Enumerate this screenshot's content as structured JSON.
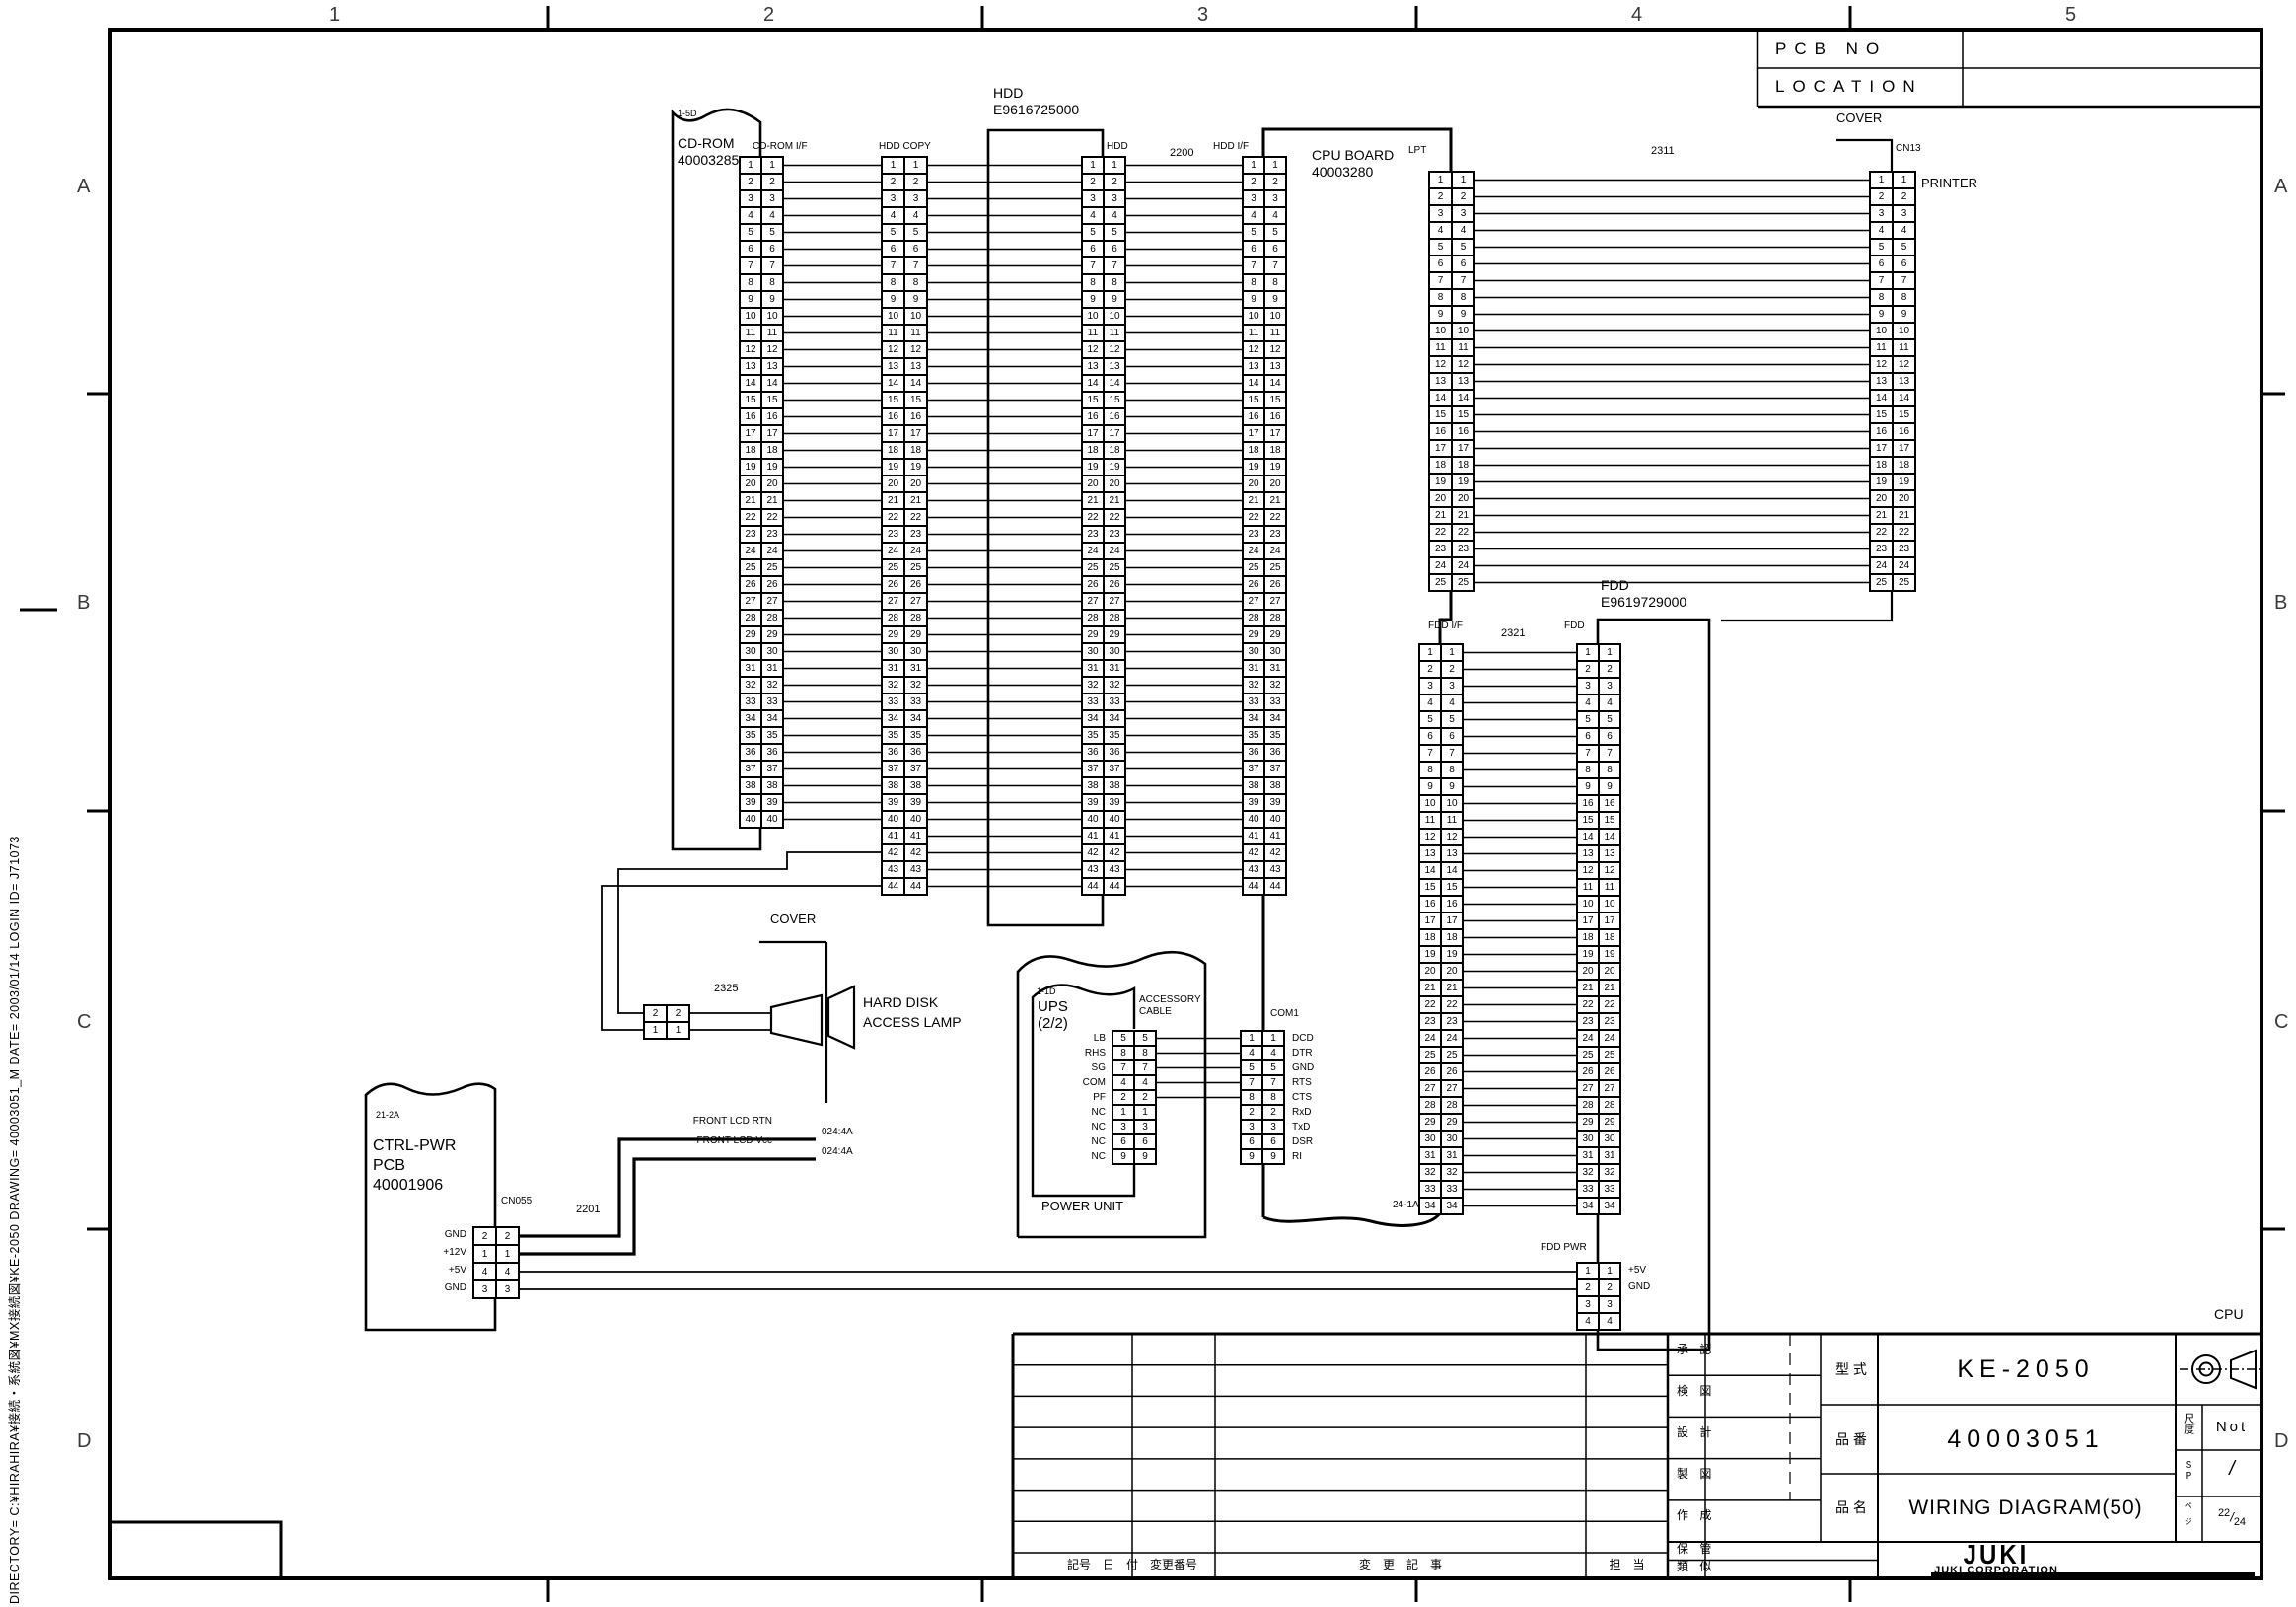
{
  "frame": {
    "zone_cols": [
      "1",
      "2",
      "3",
      "4",
      "5"
    ],
    "zone_rows": [
      "A",
      "B",
      "C",
      "D"
    ],
    "footer_note": "DIRECTORY= C:¥HIRAHIRA¥接続・系統図¥MX接続図¥KE-2050 DRAWING= 40003051_M DATE= 2003/01/14 LOGIN ID= J71073"
  },
  "pcb_table": {
    "row1_label": "PCB NO",
    "row2_label": "LOCATION"
  },
  "labels": {
    "cover_top": "COVER",
    "cn13": "CN13",
    "printer": "PRINTER",
    "cable_2311": "2311",
    "lpt": "LPT",
    "cpu_board_l1": "CPU BOARD",
    "cpu_board_l2": "40003280",
    "cdrom_zone": "1-5D",
    "cdrom_l1": "CD-ROM",
    "cdrom_l2": "40003285",
    "cdrom_if": "CD-ROM I/F",
    "hdd_copy": "HDD COPY",
    "hdd_unit_l1": "HDD",
    "hdd_unit_l2": "E9616725000",
    "hdd": "HDD",
    "cable_2200": "2200",
    "hdd_if": "HDD I/F",
    "fdd_unit_l1": "FDD",
    "fdd_unit_l2": "E9619729000",
    "fdd_if": "FDD I/F",
    "cable_2321": "2321",
    "fdd": "FDD",
    "zone_24_1a": "24-1A",
    "fdd_pwr": "FDD PWR",
    "com1": "COM1",
    "ups_zone": "1-1D",
    "ups_l1": "UPS",
    "ups_l2": "(2/2)",
    "accessory_l1": "ACCESSORY",
    "accessory_l2": "CABLE",
    "power_unit": "POWER UNIT",
    "ctrl_zone": "21-2A",
    "ctrl_l1": "CTRL-PWR",
    "ctrl_l2": "PCB",
    "ctrl_l3": "40001906",
    "cn055": "CN055",
    "cable_2201": "2201",
    "front_lcd_rtn": "FRONT LCD RTN",
    "front_lcd_vcc": "FRONT LCD Vcc",
    "dest_rtn": "024:4A",
    "dest_vcc": "024:4A",
    "cover_mid": "COVER",
    "cable_2325": "2325",
    "lamp_l1": "HARD DISK",
    "lamp_l2": "ACCESS LAMP",
    "cpu_note": "CPU"
  },
  "connectors": {
    "cdrom_if": {
      "pin_start": 1,
      "pin_count": 40
    },
    "hdd_copy": {
      "pin_start": 1,
      "pin_count": 44
    },
    "hdd": {
      "pin_start": 1,
      "pin_count": 44
    },
    "hdd_if": {
      "pin_start": 1,
      "pin_count": 44
    },
    "lpt": {
      "pin_start": 1,
      "pin_count": 25
    },
    "cn13": {
      "pin_start": 1,
      "pin_count": 25
    },
    "fdd_if": {
      "pin_start": 1,
      "pin_count": 34
    },
    "fdd": {
      "pins": [
        1,
        2,
        3,
        4,
        5,
        6,
        7,
        8,
        9,
        16,
        15,
        14,
        13,
        12,
        11,
        10,
        17,
        18,
        19,
        20,
        21,
        22,
        23,
        24,
        25,
        26,
        27,
        28,
        29,
        30,
        31,
        32,
        33,
        34
      ]
    },
    "fdd_pwr": {
      "pins": [
        1,
        2,
        3,
        4
      ],
      "right_labels": [
        "+5V",
        "GND",
        "",
        ""
      ]
    },
    "com1": {
      "pins": [
        1,
        4,
        5,
        7,
        8,
        2,
        3,
        6,
        9
      ],
      "right_labels": [
        "DCD",
        "DTR",
        "GND",
        "RTS",
        "CTS",
        "RxD",
        "TxD",
        "DSR",
        "RI"
      ]
    },
    "ups_acc": {
      "pins": [
        5,
        8,
        7,
        4,
        2,
        1,
        3,
        6,
        9
      ],
      "left_labels": [
        "LB",
        "RHS",
        "SG",
        "COM",
        "PF",
        "NC",
        "NC",
        "NC",
        "NC"
      ]
    },
    "cn055": {
      "pins": [
        2,
        1,
        4,
        3
      ],
      "left_labels": [
        "GND",
        "+12V",
        "+5V",
        "GND"
      ]
    },
    "lamp": {
      "pins": [
        2,
        1
      ]
    }
  },
  "title_block": {
    "model_label": "型 式",
    "model": "KE-2050",
    "part_label": "品 番",
    "part": "40003051",
    "name_label": "品 名",
    "name": "WIRING DIAGRAM(50)",
    "scale_label": "尺度",
    "scale_value": "Not",
    "sp_label": "SP",
    "sp_value": "/",
    "page_label": "ページ",
    "page_num": "22",
    "page_slash": "/",
    "page_den": "24",
    "approvals": [
      "承 認",
      "検 図",
      "設 計",
      "製 図",
      "作 成",
      "保 管",
      "類 似"
    ],
    "rev_header": {
      "mark_date": "記号　日　付",
      "change_no": "変更番号",
      "change_desc": "変　更　記　事",
      "charge": "担　当"
    },
    "company": "JUKI",
    "company_full": "JUKI CORPORATION"
  }
}
